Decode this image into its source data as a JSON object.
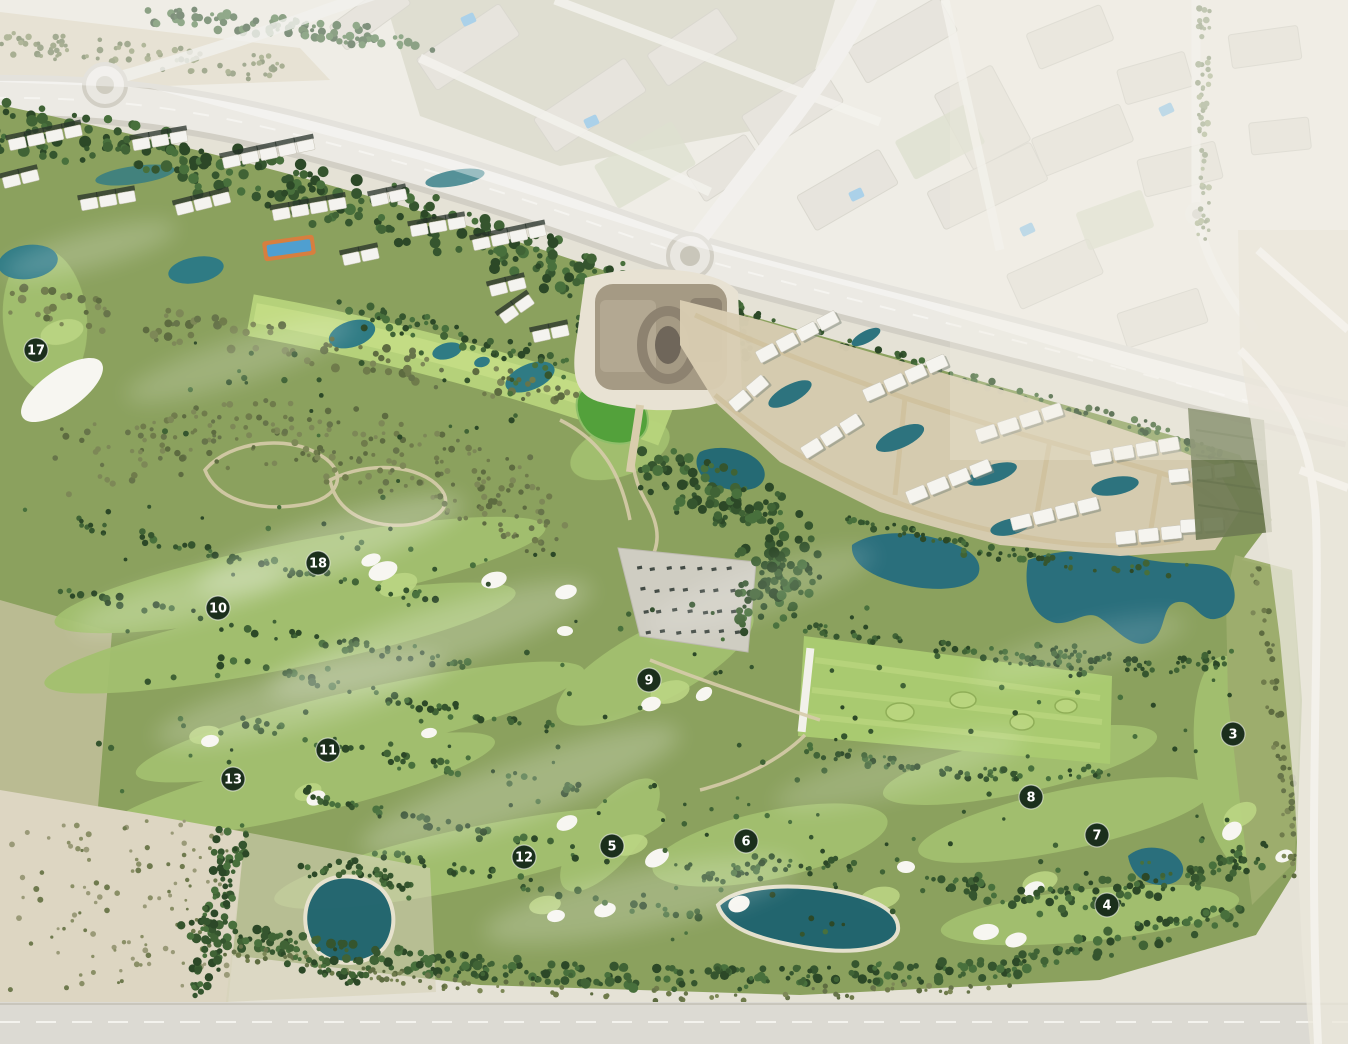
{
  "map": {
    "type": "masterplan-aerial",
    "hole_markers": [
      {
        "label": "17",
        "x": 36,
        "y": 350
      },
      {
        "label": "18",
        "x": 318,
        "y": 563
      },
      {
        "label": "10",
        "x": 218,
        "y": 608
      },
      {
        "label": "9",
        "x": 649,
        "y": 680
      },
      {
        "label": "11",
        "x": 328,
        "y": 750
      },
      {
        "label": "13",
        "x": 233,
        "y": 779
      },
      {
        "label": "12",
        "x": 524,
        "y": 857
      },
      {
        "label": "5",
        "x": 612,
        "y": 846
      },
      {
        "label": "6",
        "x": 746,
        "y": 841
      },
      {
        "label": "3",
        "x": 1233,
        "y": 734
      },
      {
        "label": "8",
        "x": 1031,
        "y": 797
      },
      {
        "label": "7",
        "x": 1097,
        "y": 835
      },
      {
        "label": "4",
        "x": 1107,
        "y": 905
      }
    ],
    "marker_style": {
      "bg": "#1b2f1c",
      "text": "#ffffff",
      "ring": "#ffffff"
    },
    "palette": {
      "course_green": "#8ba15e",
      "fairway": "#a3c06f",
      "bright_fairway": "#b7d47b",
      "trees_dark": "#35552e",
      "water": "#2a6f7c",
      "water_dark": "#1f646f",
      "sand": "#ddd6c2",
      "bunker": "#f7f6f1",
      "road": "#e9e7e1",
      "city_block": "#d7d3c6",
      "development": "#d8cdb2",
      "pool_blue": "#74b3da"
    }
  }
}
